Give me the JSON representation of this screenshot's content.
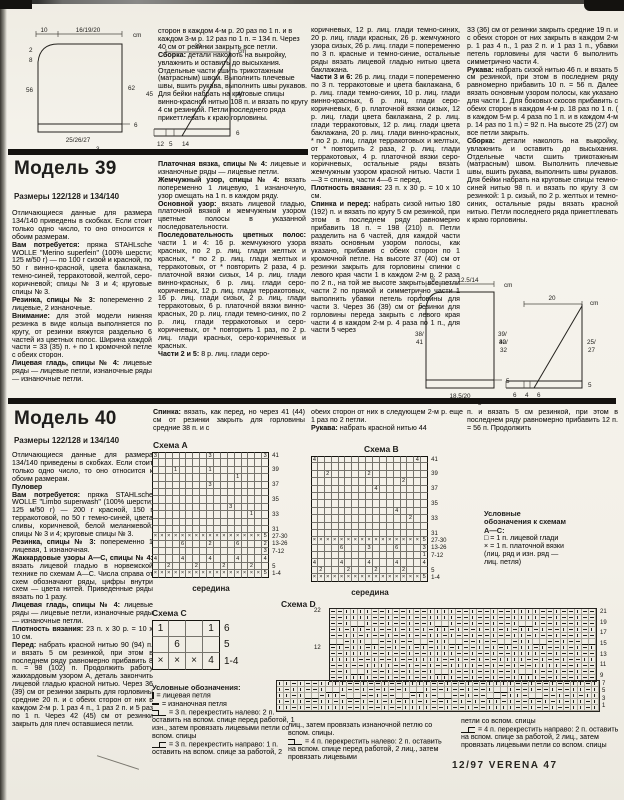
{
  "page": {
    "footer": "12/97 VERENA  47"
  },
  "prev_article": {
    "paragraphs": [
      {
        "t": "сторон в каждом 4-м р. 20 раз по 1 п. и в каждом 3-м р. 12 раз по 1 п. = 134 п. Через 40 см от резинки закрыть все петли."
      },
      {
        "b": "Сборка:",
        "t": "детали наколоть на выкройку, увлажнить и оставить до высыхания. Отдельные части сшить трикотажным (матрасным) швом. Выполнить плечевые швы, вшить рукава, выполнить швы рукавов. Для бейки набрать на круговые спицы винно-красной нитью 108 п. и вязать по кругу 4 см резинкой. Петли последнего ряда прикеттлевать к краю горловины."
      }
    ]
  },
  "model39": {
    "title": "Модель 39",
    "sizes": "Размеры 122/128 и 134/140",
    "col1": [
      {
        "t": "Отличающиеся данные для размера 134/140 приведены в скобках. Если стоит только одно число, то оно относится к обоим размерам."
      },
      {
        "b": "Вам потребуется:",
        "t": "пряжа STAHLsche WOLLE \"Merino superfein\" (100% шерсти; 125 м/50 г) — по 100 г сизой и красной, по 50 г винно-красной, цвета баклажана, темно-синей, терракотовой, желтой, серо-коричневой; спицы № 3 и 4; круговые спицы № 3."
      },
      {
        "b": "Резинка, спицы № 3:",
        "t": "попеременно 2 лицевые, 2 изнаночные."
      },
      {
        "b": "Внимание:",
        "t": "для этой модели нижняя резинка в виде кольца выполняется по кругу, от резинки вяжутся раздельно 6 частей из цветных полос. Ширина каждой части = 33 (35) п. + по 1 кромочной петле с обеих сторон."
      },
      {
        "b": "Лицевая гладь, спицы № 4:",
        "t": "лицевые ряды — лицевые петли, изнаночные ряды — изнаночные петли."
      }
    ],
    "col2": [
      {
        "b": "Платочная вязка, спицы № 4:",
        "t": "лицевые и изнаночные ряды — лицевые петли."
      },
      {
        "b": "Жемчужный узор, спицы № 4:",
        "t": "вязать попеременно 1 лицевую, 1 изнаночную, узор смещать на 1 п. в каждом ряду."
      },
      {
        "b": "Основной узор:",
        "t": "вязать лицевой гладью, платочной вязкой и жемчужным узором цветные полосы в указанной последовательности."
      },
      {
        "b": "Последовательность цветных полос:",
        "t": "части 1 и 4: 16 р. жемчужного узора красных, по 2 р. лиц. глади желтых и красных, * по 2 р. лиц. глади желтых и терракотовых, от * повторить 2 раза, 4 р. платочной вязки сизых, 14 р. лиц. глади винно-красных, 6 р. лиц. глади серо-коричневых, 12 р. лиц. глади терракотовых, 16 р. лиц. глади сизых, 2 р. лиц. глади терракотовых, 6 р. платочной вязки винно-красных, 20 р. лиц. глади темно-синих, по 2 р. лиц. глади терракотовых и серо-коричневых, от * повторить 1 раз, по 2 р. лиц. глади красных, серо-коричневых и красных."
      },
      {
        "b": "Части 2 и 5:",
        "t": "8 р. лиц. глади серо-"
      }
    ],
    "col3": [
      {
        "t": "коричневых, 12 р. лиц. глади темно-синих, 20 р. лиц. глади красных, 26 р. жемчужного узора сизых, 26 р. лиц. глади = попеременно по 3 п. красные и темно-синие, остальные ряды вязать лицевой гладью нитью цвета баклажана."
      },
      {
        "b": "Части 3 и 6:",
        "t": "26 р. лиц. глади = попеременно по 3 п. терракотовые и цвета баклажана, 6 р. лиц. глади темно-синих, 10 р. лиц. глади винно-красных, 6 р. лиц. глади серо-коричневых, 6 р. платочной вязки сизых, 12 р. лиц. глади цвета баклажана, 2 р. лиц. глади терракотовых, 12 р. лиц. глади цвета баклажана, 20 р. лиц. глади винно-красных, * по 2 р. лиц. глади терракотовых и желтых, от * повторить 2 раза, 2 р. лиц. глади терракотовых, 4 р. платочной вязки серо-коричневых, остальные ряды вязать жемчужным узором красной нитью. Части 1—3 = спинка, части 4—6 = перед."
      },
      {
        "b": "Плотность вязания:",
        "t": "23 п. х 30 р. = 10 х 10 см."
      },
      {
        "b": "Спинка и перед:",
        "t": "набрать сизой нитью 180 (192) п. и вязать по кругу 5 см резинкой, при этом в последнем ряду равномерно прибавить 18 п. = 198 (210) п. Петли разделить на 6 частей, для каждой части вязать основным узором полосы, как указано, прибавив с обеих сторон по 1 кромочной петле. На высоте 37 (40) см от резинки закрыть для горловины спинки с левого края части 1 в каждом 2-м р. 2 раза по 2 п., на той же высоте закрыть все петли части 2 по прямой и симметрично части 1 выполнить убавки петель горловины для части 3. Через 36 (39) см от резинки для горловины переда закрыть с левого края части 4 в каждом 2-м р. 4 раза по 1 п., для части 5 через"
      }
    ],
    "col4": [
      {
        "t": "33 (36) см от резинки закрыть средние 19 п. и с обеих сторон от них закрыть в каждом 2-м р. 1 раз 4 п., 1 раз 2 п. и 1 раз 1 п., убавки петель горловины для части 6 выполнить симметрично части 4."
      },
      {
        "b": "Рукава:",
        "t": "набрать сизой нитью 46 п. и вязать 5 см резинкой, при этом в последнем ряду равномерно прибавить 10 п. = 56 п. Далее вязать основным узором полосы, как указано для части 1. Для боковых скосов прибавить с обеих сторон в каждом 4-м р. 18 раз по 1 п. ( в каждом 5-м р. 4 раза по 1 п. и в каждом 4-м р. 14 раз по 1 п.) = 92 п. На высоте 25 (27) см все петли закрыть."
      },
      {
        "b": "Сборка:",
        "t": "детали наколоть на выкройку, увлажнить и оставить до высыхания. Отдельные части сшить трикотажным (матрасным) швом. Выполнить плечевые швы, вшить рукава, выполнить швы рукавов. Для бейки набрать на круговые спицы темно-синей нитью 98 п. и вязать по кругу 3 см резинкой: 1 р. сизый, по 2 р. желтых и темно-синих, остальные ряды вязать красной нитью. Петли последнего ряда прикеттлевать к краю горловины."
      }
    ]
  },
  "model40": {
    "title": "Модель 40",
    "sizes": "Размеры 122/128 и 134/140",
    "col1": [
      {
        "t": "Отличающиеся данные для размера 134/140 приведены в скобках. Если стоит только одно число, то оно относится к обоим размерам."
      },
      {
        "b": "Пуловер",
        "t": ""
      },
      {
        "b": "Вам потребуется:",
        "t": "пряжа STAHLsche WOLLE \"Limbo superwash\" (100% шерсти; 125 м/50 г) — 200 г красной, 150 г терракотовой, по 50 г темно-синей, цвета сливы, коричневой, белой меланжевой; спицы № 3 и 4; круговые спицы № 3."
      },
      {
        "b": "Резинка, спицы № 3:",
        "t": "попеременно 1 лицевая, 1 изнаночная."
      },
      {
        "b": "Жаккардовые узоры А—С, спицы № 4:",
        "t": "вязать лицевой гладью в норвежской технике по схемам А—С. Числа справа от схем обозначают ряды, цифры внутри схем — цвета нитей. Приведенные ряды вязать по 1 разу."
      },
      {
        "b": "Лицевая гладь, спицы № 4:",
        "t": "лицевые ряды — лицевые петли, изнаночные ряды — изнаночные петли."
      },
      {
        "b": "Плотность вязания:",
        "t": "23 п. х 30 р. = 10 х 10 см."
      },
      {
        "b": "Перед:",
        "t": "набрать красной нитью 90 (94) п. и вязать 5 см резинкой, при этом в последнем ряду равномерно прибавить 8 п. = 98 (102) п. Продолжить работу жаккардовым узором А, деталь закончить лицевой гладью красной нитью. Через 36 (39) см от резинки закрыть для горловины средние 20 п. и с обеих сторон от них в каждом 2-м р. 1 раз 4 п., 1 раз 2 п. и 5 раз по 1 п. Через 42 (45) см от резинки закрыть для плеч оставшиеся петли."
      }
    ],
    "col2_intro": [
      {
        "b": "Спинка:",
        "t": "вязать, как перед, но через 41 (44) см от резинки закрыть для горловины средние 38 п. и с"
      }
    ],
    "col3_intro": [
      {
        "t": "обеих сторон от них в следующем 2-м р. еще 1 раз по 2 петли."
      },
      {
        "b": "Рукава:",
        "t": "набрать красной нитью 44"
      }
    ],
    "col4_intro": [
      {
        "t": "п. и вязать 5 см резинкой, при этом в последнем ряду равномерно прибавить 12 п. = 56 п. Продолжить"
      }
    ]
  },
  "schematics": {
    "prev_body": {
      "top_a": "10",
      "top_b": "16/19/20",
      "unit": "cm",
      "n1": "2",
      "n2": "8",
      "left": "56",
      "right": "62",
      "bottom": "25/26/27",
      "b2": "3",
      "b3": "6"
    },
    "prev_sleeve": {
      "top": "29",
      "unit": "cm",
      "left": "45",
      "right": "40",
      "b1": "12",
      "b2": "5",
      "b3": "14",
      "b4": "6"
    },
    "m39_body": {
      "top_a": "9",
      "top_b": "12.5/14",
      "unit": "cm",
      "n1": "1",
      "n2": "5",
      "left1": "38/",
      "left2": "41",
      "right1": "39/",
      "right2": "42",
      "bottom": "18.5/20",
      "b2": "3",
      "b3": "5"
    },
    "m39_sleeve": {
      "top": "20",
      "unit": "cm",
      "left1": "30/",
      "left2": "32",
      "right1": "25/",
      "right2": "27",
      "b1": "6",
      "b2": "4",
      "b3": "6",
      "b4": "5"
    }
  },
  "charts": {
    "a": {
      "title": "Схема A",
      "caption": "середина",
      "cols": 17,
      "rows": [
        {
          "l": "41",
          "c": "3.......3.......3"
        },
        {
          "l": "",
          "c": "................."
        },
        {
          "l": "39",
          "c": "...1....1........"
        },
        {
          "l": "",
          "c": "............1...."
        },
        {
          "l": "37",
          "c": "........3........"
        },
        {
          "l": "",
          "c": "................."
        },
        {
          "l": "35",
          "c": "................."
        },
        {
          "l": "",
          "c": "...........3....."
        },
        {
          "l": "33",
          "c": "..............1.."
        },
        {
          "l": "",
          "c": "................."
        },
        {
          "l": "31",
          "c": "................."
        },
        {
          "l": "27-30",
          "c": "xxxxxxxxxxxxxxxx5"
        },
        {
          "l": "13-26",
          "c": "....6...2...6...2"
        },
        {
          "l": "7-12",
          "c": "................3"
        },
        {
          "l": "",
          "c": "4...4...4...4...4"
        },
        {
          "l": "5",
          "c": "..2...2...2...2.."
        },
        {
          "l": "1-4",
          "c": "xxxxxxxxxxxxxxxx5"
        }
      ]
    },
    "b": {
      "title": "Схема B",
      "caption": "середина",
      "cols": 17,
      "rows": [
        {
          "l": "41",
          "c": "4..............4."
        },
        {
          "l": "",
          "c": "................."
        },
        {
          "l": "39",
          "c": "..2.....2........"
        },
        {
          "l": "",
          "c": ".............2..."
        },
        {
          "l": "37",
          "c": ".........4......."
        },
        {
          "l": "",
          "c": "................."
        },
        {
          "l": "35",
          "c": "................."
        },
        {
          "l": "",
          "c": "............4...."
        },
        {
          "l": "33",
          "c": "..............2.."
        },
        {
          "l": "",
          "c": "................."
        },
        {
          "l": "31",
          "c": "................."
        },
        {
          "l": "27-30",
          "c": "xxxxxxxxxxxxxxxx5"
        },
        {
          "l": "13-26",
          "c": "....6...3...6...3"
        },
        {
          "l": "7-12",
          "c": "................1"
        },
        {
          "l": "",
          "c": "4...4...4...4...4"
        },
        {
          "l": "5",
          "c": ".2...2...2...2..."
        },
        {
          "l": "1-4",
          "c": "xxxxxxxxxxxxxxxx5"
        }
      ]
    },
    "c": {
      "title": "Схема C",
      "cols": 4,
      "rows": [
        {
          "l": "6",
          "c": "1..1"
        },
        {
          "l": "5",
          "c": ".6.."
        },
        {
          "l": "1-4",
          "c": "xxx4"
        }
      ]
    },
    "d": {
      "title": "Схема D",
      "left_top": "22",
      "left_mid": "12",
      "right_upper": [
        "21",
        "19",
        "17",
        "15",
        "13",
        "11",
        "9"
      ],
      "right_lower": [
        "7",
        "5",
        "3",
        "1"
      ],
      "upper": {
        "cols": 38,
        "rows": [
          "--||||--|--|--||||--|--|--||||--|--|--",
          "--||||--|--|--||||--|--|--||||--|--|--",
          "--|__|--|--|--|__|--|--|--|__|--|--|--",
          "-|-||-|--|-|-|-||-|--|-|-|-||-|--|-|-|",
          "--||-|--|--|--||-|--|--|--||-|--|--|--",
          "__-||__--|--__-||__--|--__-||__--|--__",
          "-|-||-|--|-|-|-||-|--|-|-|-||-|--|-|-|",
          "--||||--|--|--||||--|--|--||||--|--|--",
          "||||--|--|--||||--|--|--||||--|--|--||",
          "--|--||||--|--|--||||--|--|--||||--|--",
          "--|__|--|--|--|__|--|--|--|__|--|--|--",
          "--||||--|--|--||||--|--|--||||--|--|--"
        ]
      },
      "lower": {
        "cols": 46,
        "rows": [
          "||-|--||||--|--|--||||--|--|--||||--|--|--||-|",
          "|-||--|__|--|--|--|__|--|--|--|__|--|--|--||-|",
          "||-|__-||-__--|--__-||-__--|--__-||-__--|-|-||",
          "|-||--||-|--|-|-|-||-|--|-|-|-||-|--|-|-|-||-|",
          "||-|--||||--|--|--||||--|--|--||||--|--|--||-|"
        ]
      }
    }
  },
  "legend_abc": {
    "title": "Условные обозначения к схемам А—С:",
    "items": [
      {
        "t": "□ = 1 п. лицевой глади"
      },
      {
        "t": "× = 1 п. платочной вязки (лиц. ряд и изн. ряд — лиц. петля)"
      }
    ]
  },
  "legend": {
    "title": "Условные обозначения:",
    "col2": [
      {
        "sym": "sym-knit",
        "t": "= лицевая петля"
      },
      {
        "sym": "sym-purl",
        "t": "= изнаночная петля"
      },
      {
        "sym": "sym-c3l",
        "t": "= 3 п. перекрестить налево: 2 п. оставить на вспом. спице перед работой, 1 изн., затем провязать лицевыми петли со вспом. спицы"
      },
      {
        "sym": "sym-c3r",
        "t": "= 3 п. перекрестить направо: 1 п. оставить на вспом. спице за работой, 2"
      }
    ],
    "col3": [
      {
        "t": "лиц., затем провязать изнаночной петлю со вспом. спицы."
      },
      {
        "sym": "sym-c4l",
        "t": "= 4 п. перекрестить налево: 2 п. оставить на вспом. спице перед работой, 2 лиц., затем провязать лицевыми"
      }
    ],
    "col4": [
      {
        "t": "петли со вспом. спицы"
      },
      {
        "sym": "sym-c4r",
        "t": "= 4 п. перекрестить направо: 2 п. оставить на вспом. спице за работой, 2 лиц., затем провязать лицевыми петли со вспом. спицы"
      }
    ]
  }
}
